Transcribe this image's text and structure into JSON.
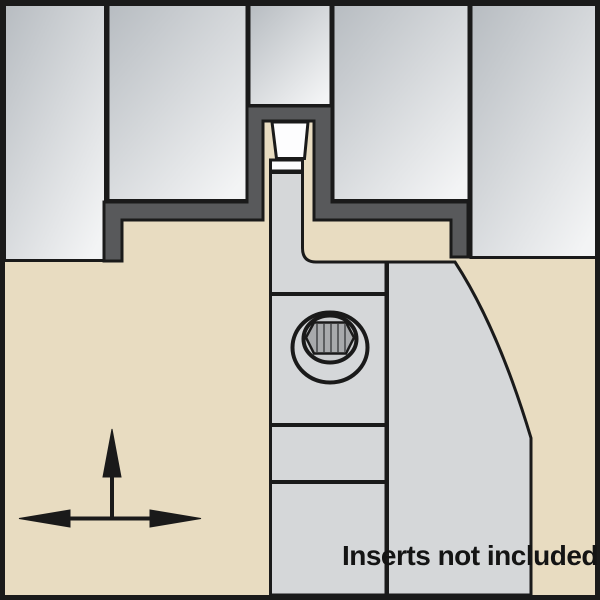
{
  "caption": {
    "text": "Inserts not included"
  },
  "colors": {
    "background": "#e8dcc1",
    "line": "#1a1a1a",
    "frame": "#1a1a1a",
    "groove_profile_dark": "#58595b",
    "block_gradient_start": "#b7bcc1",
    "block_gradient_end": "#f3f4f5",
    "tool_body": "#d5d7d9",
    "insert_face": "#fdfdfe",
    "screw_face": "#cbcdcf",
    "torx_fill": "#a8aaac",
    "torx_rib": "#5c5e60",
    "arrow": "#1a1a1a",
    "caption_color": "#141414"
  },
  "icons": {
    "screw": "torx-screw-icon",
    "up_arrow": "up-arrow-icon",
    "left_right_arrow": "left-right-arrow-icon"
  }
}
